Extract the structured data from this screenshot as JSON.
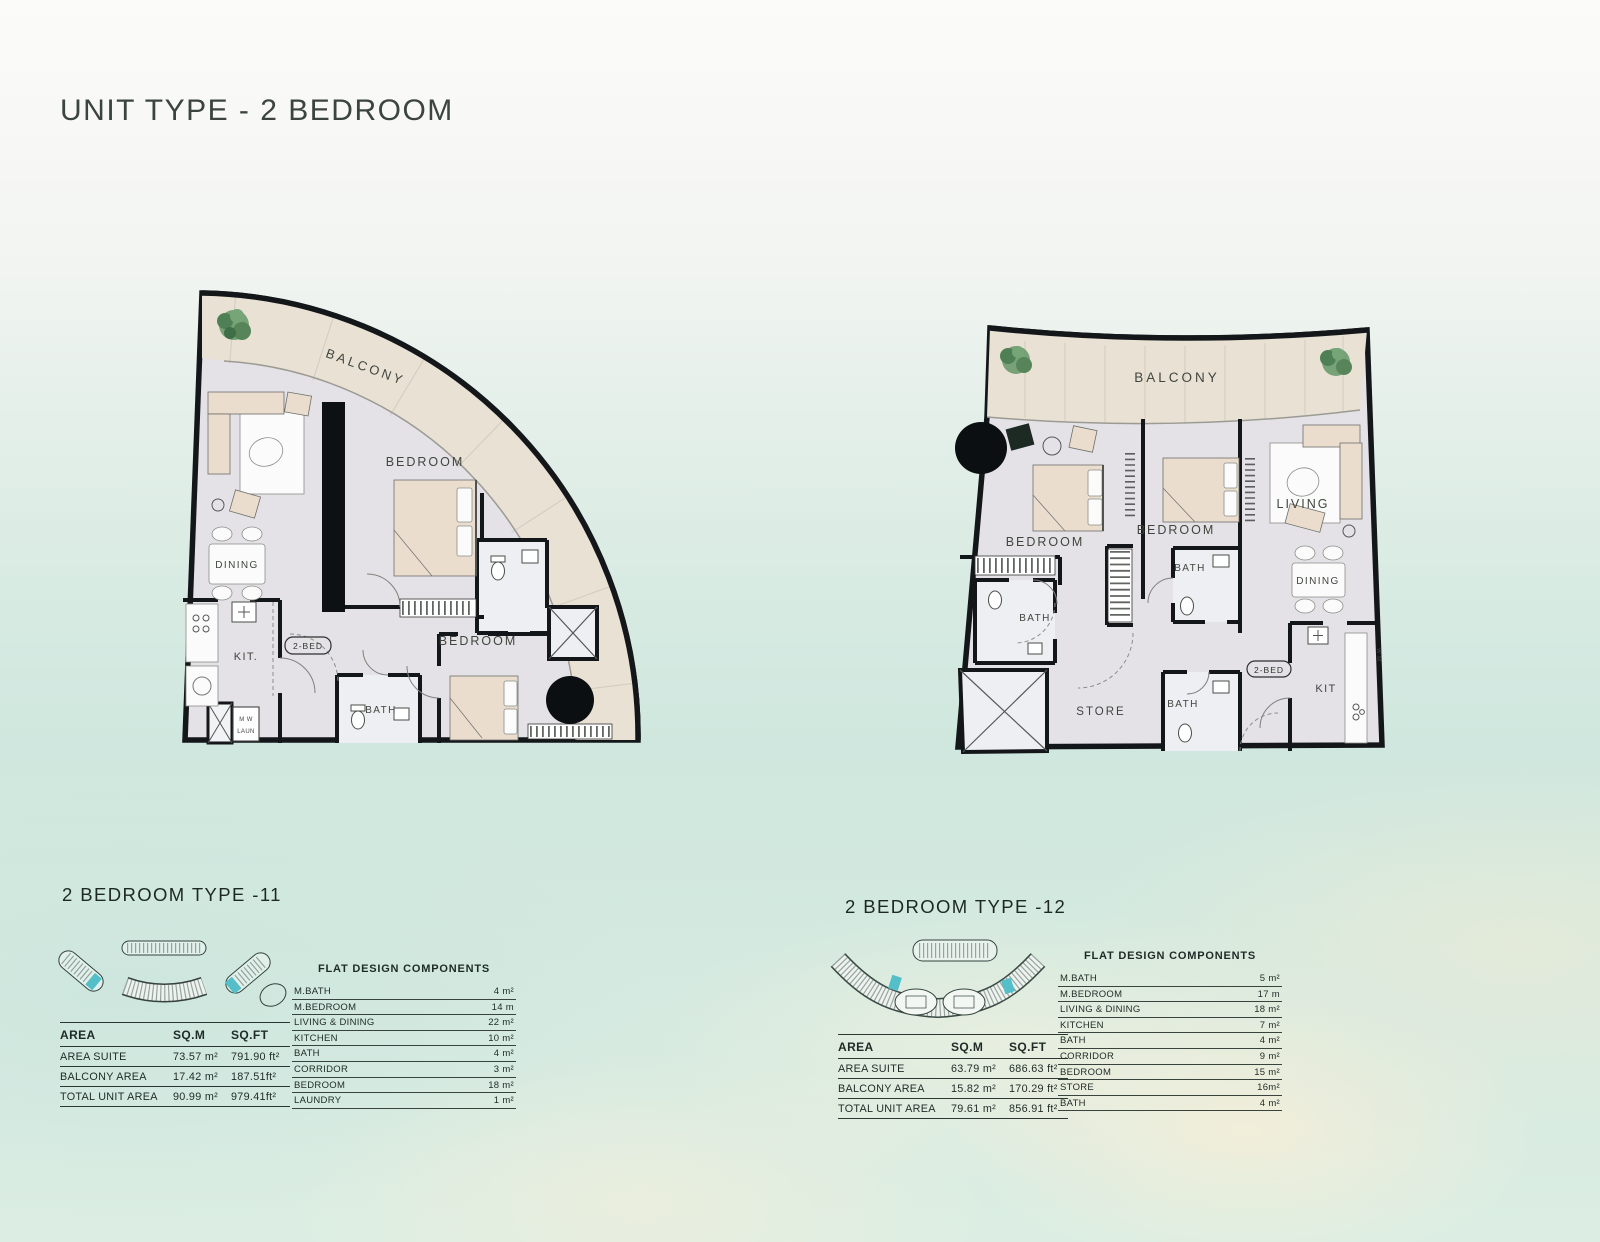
{
  "page_title": "UNIT TYPE - 2 BEDROOM",
  "colors": {
    "wall": "#14171a",
    "balcony_fill": "#e9e1d4",
    "interior_fill": "#e4e2e6",
    "furniture_fill": "#ebddce",
    "keyplan_highlight": "#54bfc9",
    "tree_green": "#5f8f5f",
    "text_dark": "#1f2a26",
    "sea_background": "#d3e9df"
  },
  "left_unit": {
    "heading": "2 BEDROOM TYPE -11",
    "plan": {
      "balcony": "BALCONY",
      "bedroom_top": "BEDROOM",
      "bedroom_bottom": "BEDROOM",
      "dining": "DINING",
      "kitchen": "KIT.",
      "bath": "BATH",
      "unit_tag": "2-BED",
      "washer": "M W",
      "laundry": "LAUN"
    },
    "area_table": {
      "headers": [
        "AREA",
        "SQ.M",
        "SQ.FT"
      ],
      "rows": [
        {
          "label": "AREA SUITE",
          "sqm": "73.57 m²",
          "sqft": "791.90 ft²"
        },
        {
          "label": "BALCONY AREA",
          "sqm": "17.42 m²",
          "sqft": "187.51ft²"
        },
        {
          "label": "TOTAL UNIT AREA",
          "sqm": "90.99 m²",
          "sqft": "979.41ft²"
        }
      ]
    },
    "components": {
      "title": "FLAT DESIGN COMPONENTS",
      "rows": [
        {
          "label": "M.BATH",
          "value": "4 m²"
        },
        {
          "label": "M.BEDROOM",
          "value": "14 m"
        },
        {
          "label": "LIVING & DINING",
          "value": "22 m²"
        },
        {
          "label": "KITCHEN",
          "value": "10 m²"
        },
        {
          "label": "BATH",
          "value": "4 m²"
        },
        {
          "label": "CORRIDOR",
          "value": "3 m²"
        },
        {
          "label": "BEDROOM",
          "value": "18 m²"
        },
        {
          "label": "LAUNDRY",
          "value": "1 m²"
        }
      ]
    }
  },
  "right_unit": {
    "heading": "2 BEDROOM TYPE -12",
    "plan": {
      "balcony": "BALCONY",
      "bedroom_left": "BEDROOM",
      "bedroom_mid": "BEDROOM",
      "living": "LIVING",
      "dining": "DINING",
      "kitchen": "KIT",
      "store": "STORE",
      "bath_left": "BATH",
      "bath_mid": "BATH",
      "bath_bottom": "BATH",
      "unit_tag": "2-BED",
      "washer": "W M"
    },
    "area_table": {
      "headers": [
        "AREA",
        "SQ.M",
        "SQ.FT"
      ],
      "rows": [
        {
          "label": "AREA SUITE",
          "sqm": "63.79 m²",
          "sqft": "686.63 ft²"
        },
        {
          "label": "BALCONY AREA",
          "sqm": "15.82 m²",
          "sqft": "170.29 ft²"
        },
        {
          "label": "TOTAL UNIT AREA",
          "sqm": "79.61 m²",
          "sqft": "856.91 ft²"
        }
      ]
    },
    "components": {
      "title": "FLAT DESIGN COMPONENTS",
      "rows": [
        {
          "label": "M.BATH",
          "value": "5 m²"
        },
        {
          "label": "M.BEDROOM",
          "value": "17 m"
        },
        {
          "label": "LIVING & DINING",
          "value": "18 m²"
        },
        {
          "label": "KITCHEN",
          "value": "7 m²"
        },
        {
          "label": "BATH",
          "value": "4 m²"
        },
        {
          "label": "CORRIDOR",
          "value": "9 m²"
        },
        {
          "label": "BEDROOM",
          "value": "15 m²"
        },
        {
          "label": "STORE",
          "value": "16m²"
        },
        {
          "label": "BATH",
          "value": "4 m²"
        }
      ]
    }
  }
}
